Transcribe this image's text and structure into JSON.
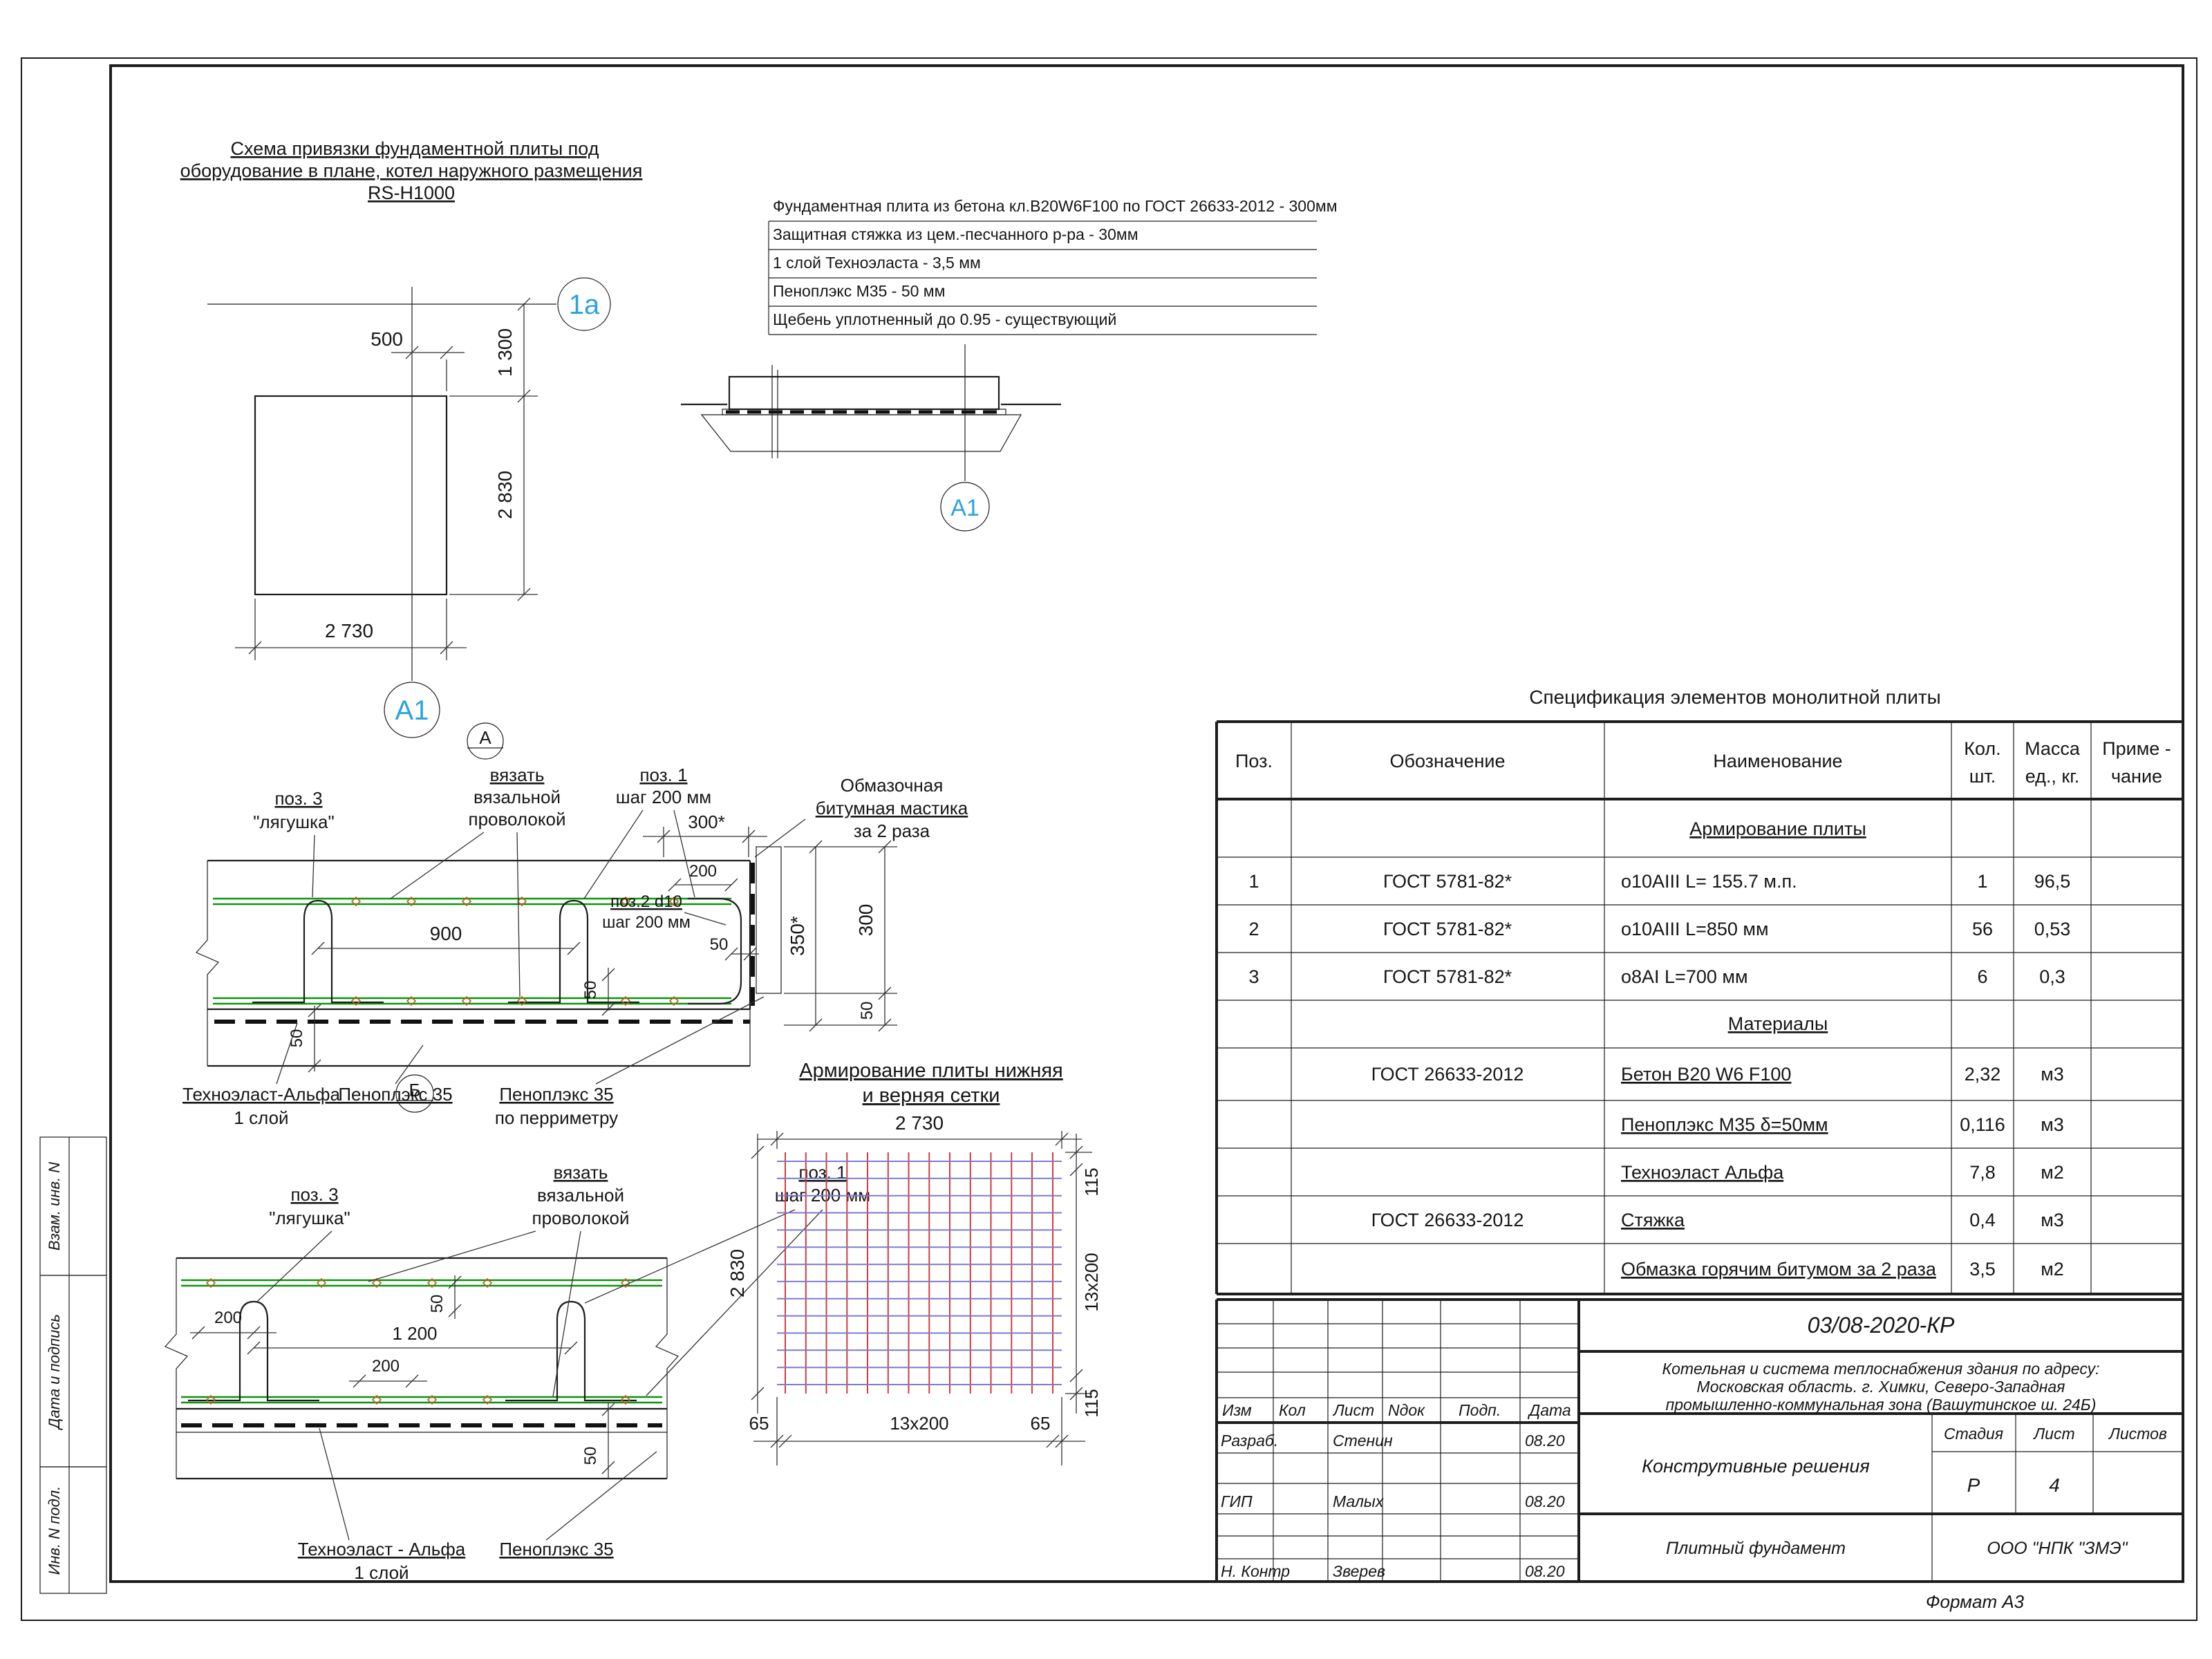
{
  "meta": {
    "format": "Формат А3"
  },
  "stamps": {
    "s1": "Взам. инв. N",
    "s2": "Дата и подпись",
    "s3": "Инв. N подл."
  },
  "plan": {
    "title1": "Схема привязки фундаментной плиты под",
    "title2": "оборудование в плане, котел наружного размещения",
    "title3": "RS-H1000",
    "axis_h": "1a",
    "axis_v": "A1",
    "d500": "500",
    "d1300": "1 300",
    "d2830": "2 830",
    "d2730": "2 730",
    "section_mark_a": "А"
  },
  "layers": {
    "marker": "A1",
    "l1": "Фундаментная плита из бетона кл.B20W6F100 по ГОСТ 26633-2012 - 300мм",
    "l2": "Защитная стяжка из цем.-песчанного р-ра - 30мм",
    "l3": "1 слой Техноэласта - 3,5 мм",
    "l4": "Пеноплэкс М35 - 50 мм",
    "l5": "Щебень уплотненный до 0.95 - существующий"
  },
  "section_a": {
    "marker": "А",
    "pos3_1": "поз. 3",
    "pos3_2": "\"лягушка\"",
    "tie1": "вязать",
    "tie2": "вязальной",
    "tie3": "проволокой",
    "pos1_1": "поз. 1",
    "pos1_2": "шаг 200 мм",
    "mastic1": "Обмазочная",
    "mastic2": "битумная мастика",
    "mastic3": "за 2 раза",
    "pos2_1": "поз.2 d10",
    "pos2_2": "шаг 200 мм",
    "d900": "900",
    "d300s": "300*",
    "d200": "200",
    "d50": "50",
    "d350s": "350*",
    "d300": "300",
    "lbl_tech1": "Техноэласт-Альфа",
    "lbl_tech2": "1 слой",
    "lbl_pen": "Пеноплэкс 35",
    "lbl_pen_per1": "Пеноплэкс 35",
    "lbl_pen_per2": "по перриметру"
  },
  "section_b": {
    "marker": "Б",
    "pos3_1": "поз. 3",
    "pos3_2": "\"лягушка\"",
    "tie1": "вязать",
    "tie2": "вязальной",
    "tie3": "проволокой",
    "pos1_1": "поз. 1",
    "pos1_2": "шаг 200 мм",
    "d200": "200",
    "d1200": "1 200",
    "d50": "50",
    "lbl_tech1": "Техноэласт - Альфа",
    "lbl_tech2": "1 слой",
    "lbl_pen": "Пеноплэкс 35"
  },
  "grid": {
    "title1": "Армирование плиты нижняя",
    "title2": "и верняя сетки",
    "top": "2 730",
    "left": "2 830",
    "bottom": "13x200",
    "side_l": "65",
    "side_r": "65",
    "right_span": "13x200",
    "right_off_top": "115",
    "right_off_bot": "115"
  },
  "spec": {
    "title": "Спецификация элементов монолитной плиты",
    "h_pos": "Поз.",
    "h_des": "Обозначение",
    "h_name": "Наименование",
    "h_qty1": "Кол.",
    "h_qty2": "шт.",
    "h_mass1": "Масса",
    "h_mass2": "ед., кг.",
    "h_note1": "Приме -",
    "h_note2": "чание",
    "g1": "Армирование плиты",
    "g2": "Материалы",
    "rows": [
      {
        "pos": "1",
        "des": "ГОСТ 5781-82*",
        "name": "о10АIII L= 155.7 м.п.",
        "qty": "1",
        "mass": "96,5"
      },
      {
        "pos": "2",
        "des": "ГОСТ 5781-82*",
        "name": "о10АIII L=850 мм",
        "qty": "56",
        "mass": "0,53"
      },
      {
        "pos": "3",
        "des": "ГОСТ 5781-82*",
        "name": "о8АI L=700 мм",
        "qty": "6",
        "mass": "0,3"
      }
    ],
    "mats": [
      {
        "des": "ГОСТ 26633-2012",
        "name": "Бетон В20 W6 F100",
        "qty": "2,32",
        "unit": "м3"
      },
      {
        "des": "",
        "name": "Пеноплэкс М35 δ=50мм",
        "qty": "0,116",
        "unit": "м3"
      },
      {
        "des": "",
        "name": "Техноэласт Альфа",
        "qty": "7,8",
        "unit": "м2"
      },
      {
        "des": "ГОСТ 26633-2012",
        "name": "Стяжка",
        "qty": "0,4",
        "unit": "м3"
      },
      {
        "des": "",
        "name": "Обмазка горячим битумом за 2 раза",
        "qty": "3,5",
        "unit": "м2"
      }
    ]
  },
  "titleblock": {
    "doc": "03/08-2020-КР",
    "proj1": "Котельная и система теплоснабжения здания по адресу:",
    "proj2": "Московская область. г. Химки, Северо-Западная",
    "proj3": "промышленно-коммунальная зона (Вашутинское ш. 24Б)",
    "h_izm": "Изм",
    "h_kol": "Кол",
    "h_list": "Лист",
    "h_ndok": "Nдок",
    "h_podp": "Подп.",
    "h_data": "Дата",
    "r1_role": "Разраб.",
    "r1_name": "Стенин",
    "r1_date": "08.20",
    "r2_role": "ГИП",
    "r2_name": "Малых",
    "r2_date": "08.20",
    "r3_role": "Н. Контр",
    "r3_name": "Зверев",
    "r3_date": "08.20",
    "drawing": "Конструтивные решения",
    "h_stage": "Стадия",
    "h_sheet": "Лист",
    "h_sheets": "Листов",
    "stage": "Р",
    "sheet": "4",
    "object": "Плитный фундамент",
    "company": "ООО \"НПК \"ЗМЭ\""
  }
}
